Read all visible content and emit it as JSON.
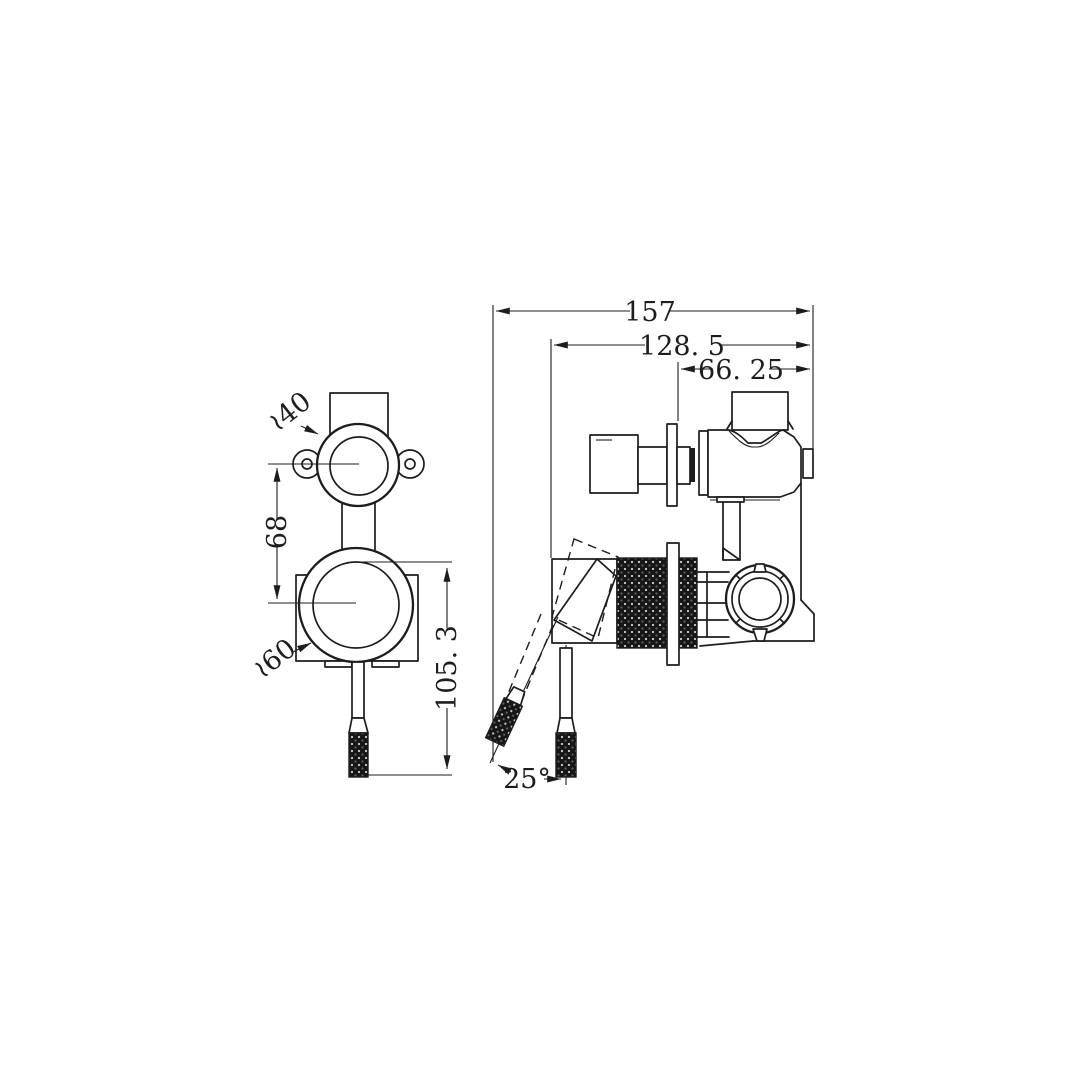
{
  "drawing": {
    "type": "technical-2d-drawing",
    "subject": "shower mixer valve with diverter - front and side orthographic views",
    "line_color": "#1d1d1d",
    "background_color": "#ffffff",
    "dimensions": {
      "overall_depth": "157",
      "body_depth": "128. 5",
      "front_projection": "66. 25",
      "top_escutcheon_diameter": "≀40",
      "centre_distance": "68",
      "bottom_escutcheon_diameter": "≀60",
      "handle_drop_height": "105. 3",
      "handle_swing_angle": "25°"
    },
    "units": "mm"
  }
}
